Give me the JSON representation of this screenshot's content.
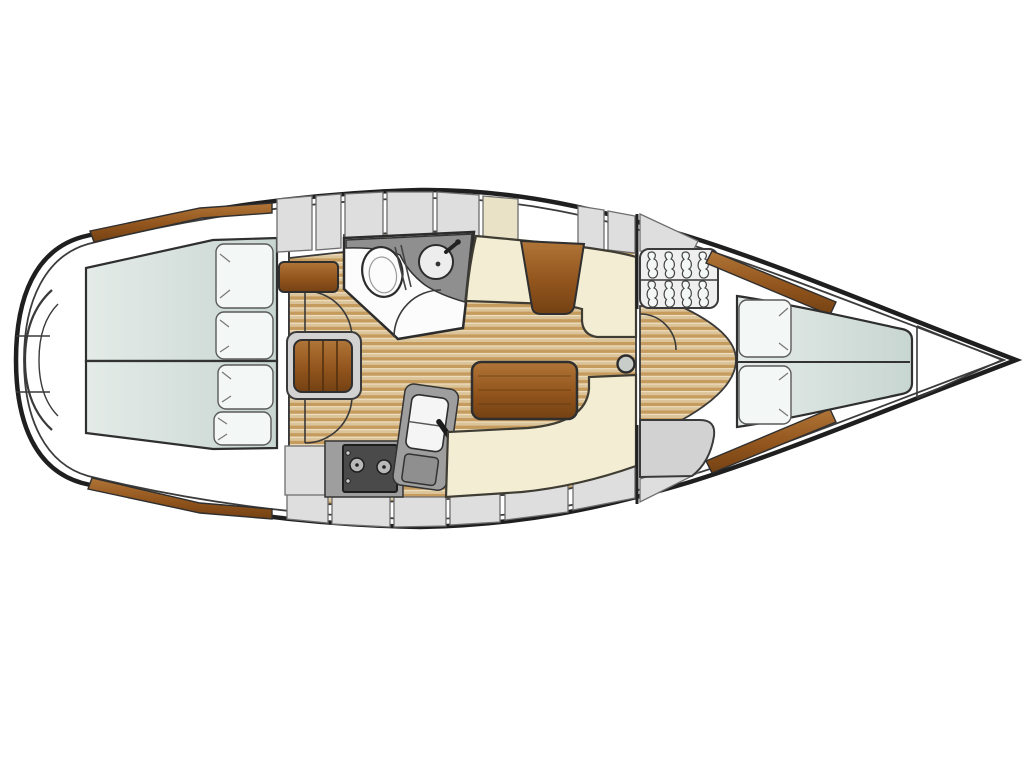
{
  "canvas": {
    "width": 1024,
    "height": 768
  },
  "palette": {
    "background": "#ffffff",
    "hull_outline": "#1f1f1f",
    "hull_inner_line": "#3c3c3c",
    "deck_white": "#ffffff",
    "teak_light": "#dcc49a",
    "teak_mid": "#c69b5e",
    "teak_line": "#efe3c6",
    "wood_light": "#b07538",
    "wood_mid": "#92551d",
    "wood_dark": "#744113",
    "settee_cream": "#f2edd3",
    "settee_cream_dark": "#e9e2c6",
    "berth_light": "#e4ebe8",
    "berth_dark": "#c8d6d1",
    "pillow_white": "#f3f7f5",
    "locker_gray": "#dedede",
    "counter_gray": "#9e9e9e",
    "dark_counter": "#8f8f8f",
    "stove_dark": "#4a4a4a",
    "fixture_white": "#fcfcfc",
    "outline": "#2c2c2c"
  },
  "diagram": {
    "type": "yacht-interior-floor-plan",
    "orientation": "bow-right-stern-left",
    "areas": [
      {
        "id": "stern-platform",
        "label": "stern swim platform"
      },
      {
        "id": "aft-cabin-port",
        "label": "aft double berth (upper)"
      },
      {
        "id": "aft-cabin-starboard",
        "label": "aft double berth (lower)"
      },
      {
        "id": "head",
        "label": "head compartment with toilet and washbasin"
      },
      {
        "id": "galley",
        "label": "galley with stove and sink"
      },
      {
        "id": "salon",
        "label": "salon with settees and tables"
      },
      {
        "id": "forward-cabin",
        "label": "forward V-berth cabin"
      },
      {
        "id": "forepeak",
        "label": "anchor locker / forepeak"
      }
    ],
    "fixtures": [
      "toilet-icon",
      "washbasin-icon",
      "faucet-icon",
      "stove-icon",
      "galley-sink-icon",
      "companionway-steps-icon",
      "hanger-icon",
      "mast-post-icon",
      "saloon-table-icon",
      "dining-table-icon",
      "door-swing-icon",
      "pillow-icon"
    ],
    "counts": {
      "hangers": 8,
      "stove_burners": 2,
      "aft_pillows": 4,
      "vberth_pillows": 2,
      "stern_steps": 3
    }
  }
}
